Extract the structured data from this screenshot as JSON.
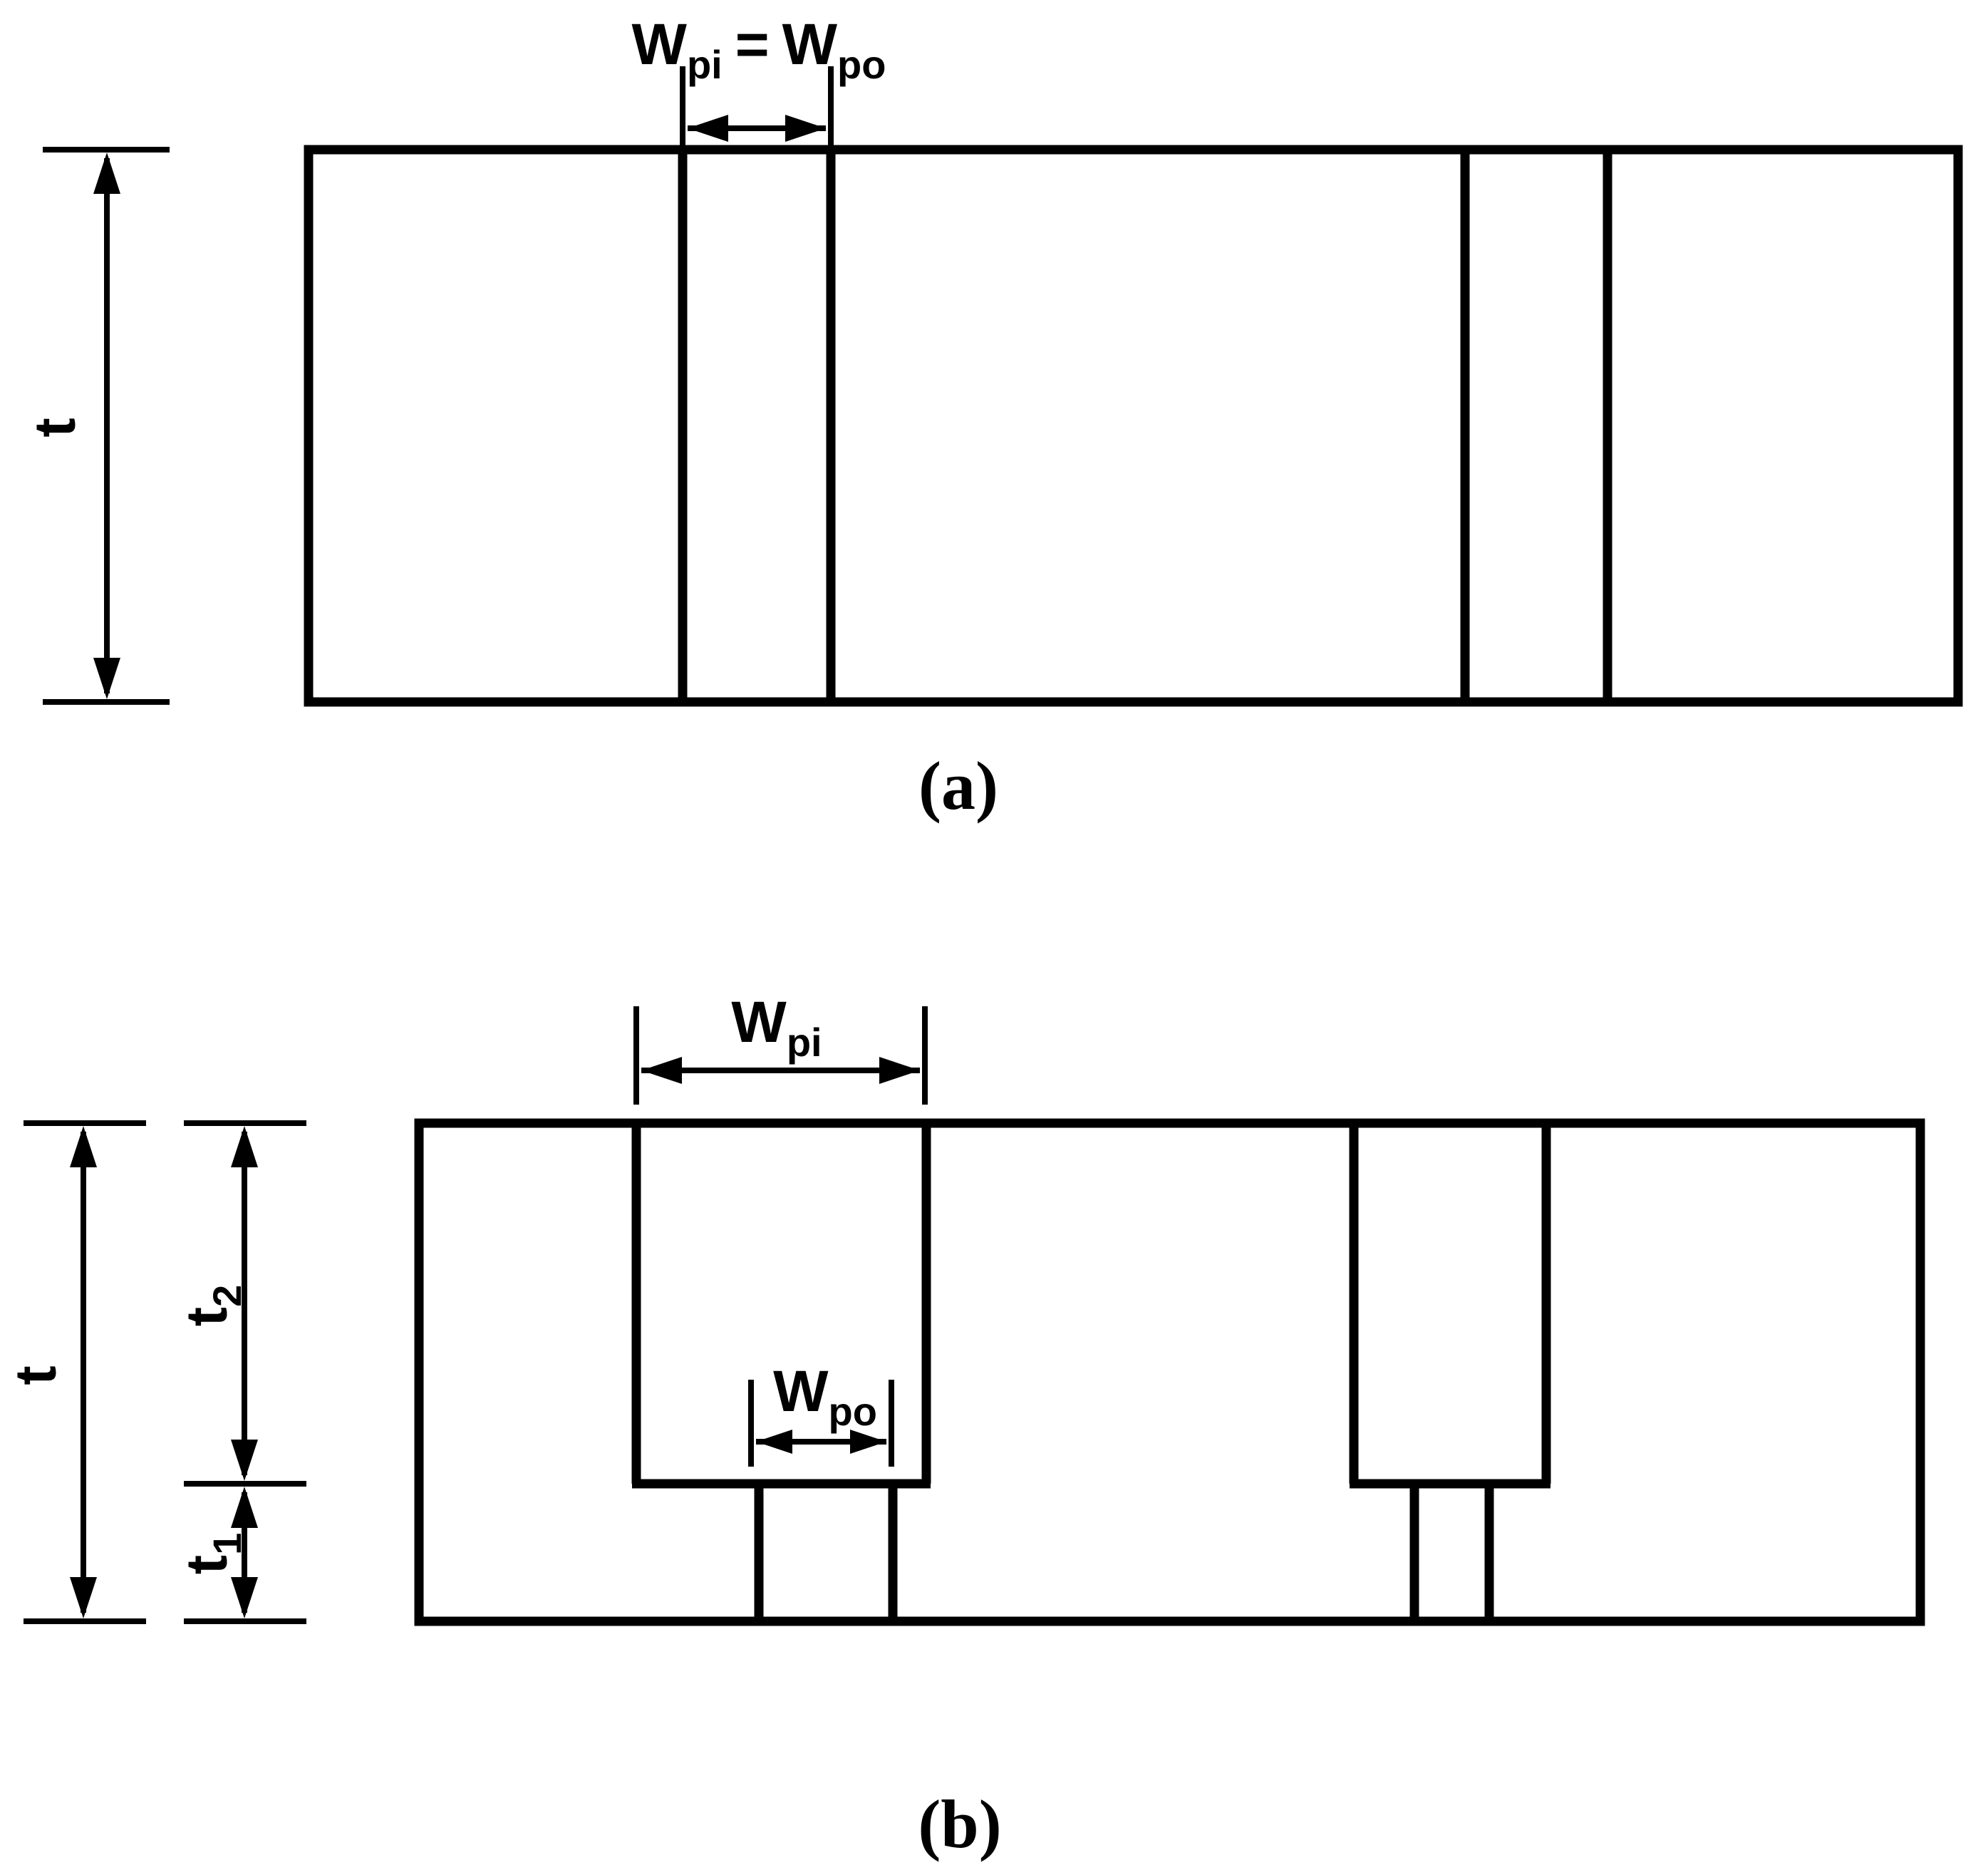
{
  "colors": {
    "line": "#000000",
    "background": "#ffffff"
  },
  "panel_a": {
    "width_dim": {
      "w1": "W",
      "sub1": "pi",
      "eq": "=",
      "w2": "W",
      "sub2": "po"
    },
    "thickness_label": "t",
    "caption": "(a)"
  },
  "panel_b": {
    "wpi": {
      "base": "W",
      "sub": "pi"
    },
    "wpo": {
      "base": "W",
      "sub": "po"
    },
    "t_label": "t",
    "t2": {
      "base": "t",
      "sub": "2"
    },
    "t1": {
      "base": "t",
      "sub": "1"
    },
    "caption": "(b)"
  }
}
